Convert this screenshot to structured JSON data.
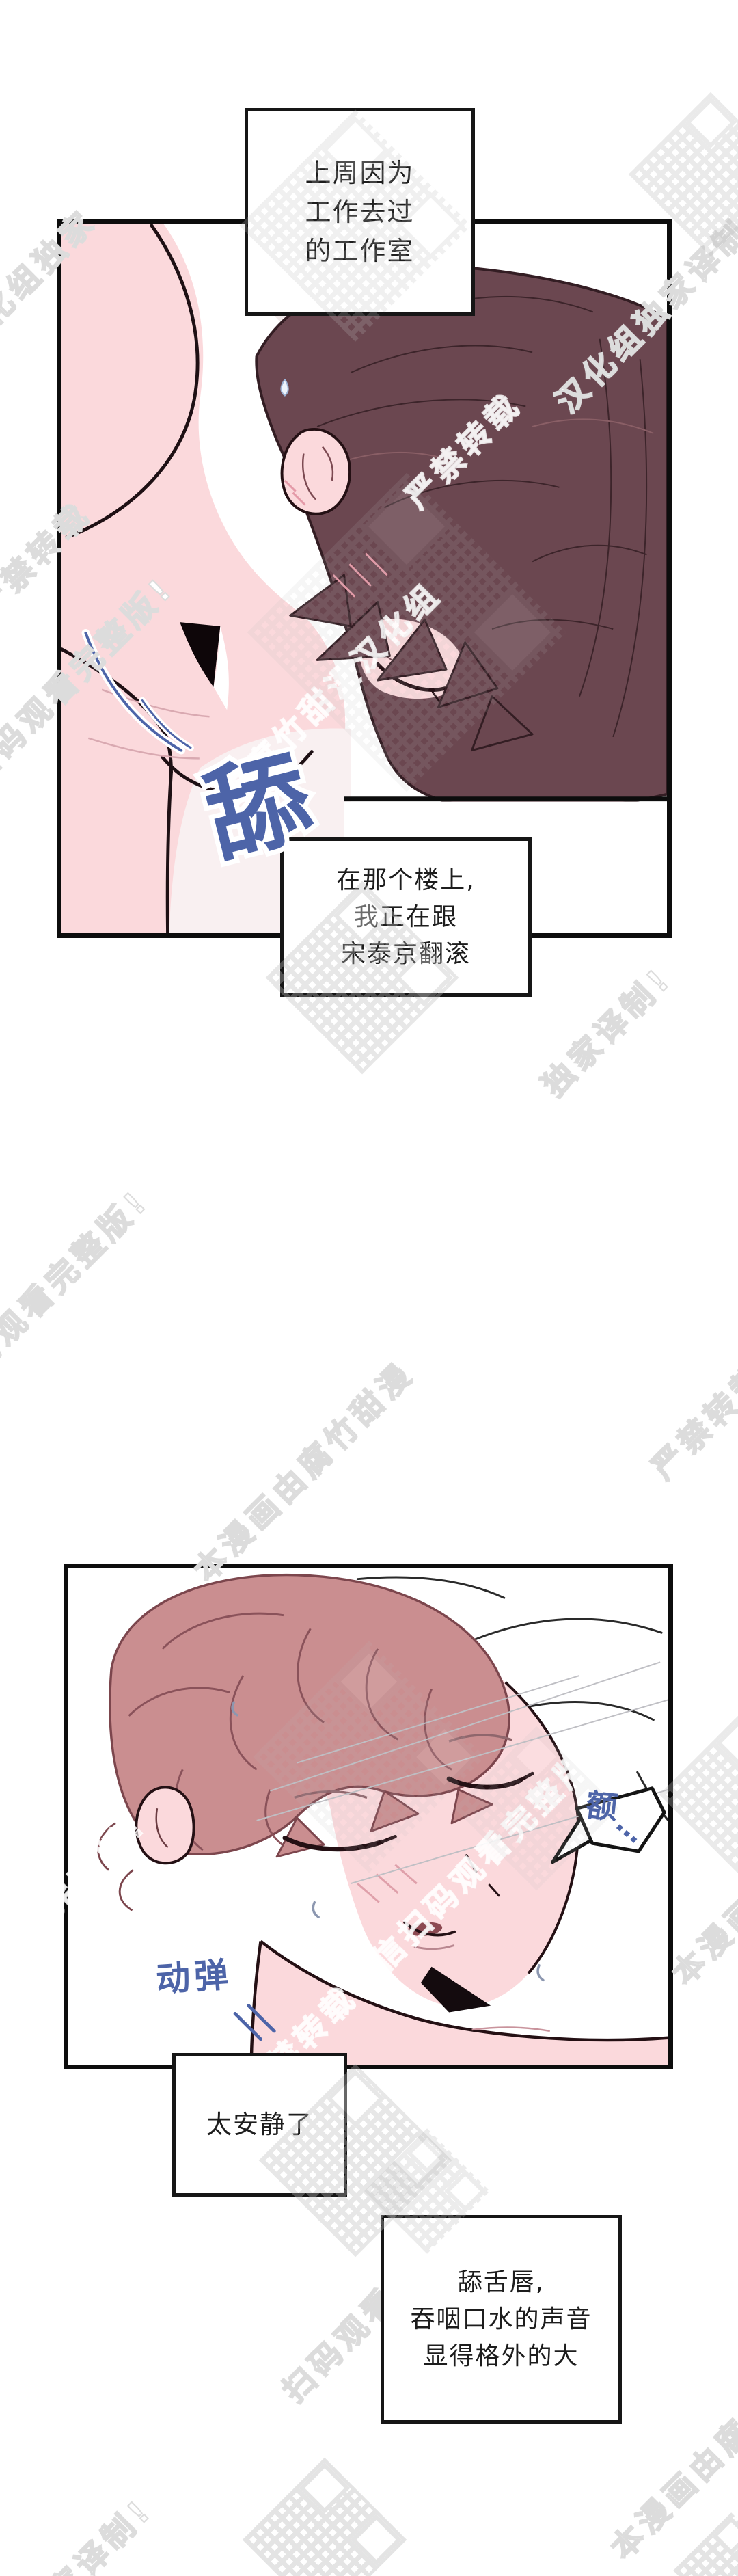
{
  "page": {
    "kind": "webtoon-page",
    "background": "#ffffff"
  },
  "panels": [
    {
      "name": "panel-studio-flashback",
      "narration": "上周因为\n工作去过\n的工作室",
      "caption": "在那个楼上,\n我正在跟\n宋泰京翻滚",
      "sfx": "舔"
    },
    {
      "name": "panel-lying-quiet",
      "bubble_text": "额",
      "bubble_dots": "…",
      "sfx": "动弹",
      "caption": "太安静了",
      "caption2": "舔舌唇,\n吞咽口水的声音\n显得格外的大"
    }
  ],
  "watermarks": {
    "texts": [
      "汉化组独家译制!",
      "严禁转载",
      "微信扫码观看完整版!",
      "由腐竹甜漫汉化组",
      "严禁转载",
      "独家译制!",
      "扫码观看完整版!",
      "本漫画由腐竹甜漫",
      "严禁转载",
      "完整版!",
      "严禁转载微信扫码观看完整版!",
      "本漫画由腐竹",
      "扫码观看完整",
      "本漫画由腐竹甜",
      "独家译制!",
      "汉化组独家"
    ]
  },
  "colors": {
    "sfx_blue": "#4d64a8",
    "skin_pink": "#fbd9dc",
    "hair_dark_maroon": "#6b4750",
    "hair_rose_pink": "#ca8e90",
    "panel_border": "#0d0d0d",
    "box_border": "#161616",
    "watermark_gray": "#dcdcdc"
  }
}
